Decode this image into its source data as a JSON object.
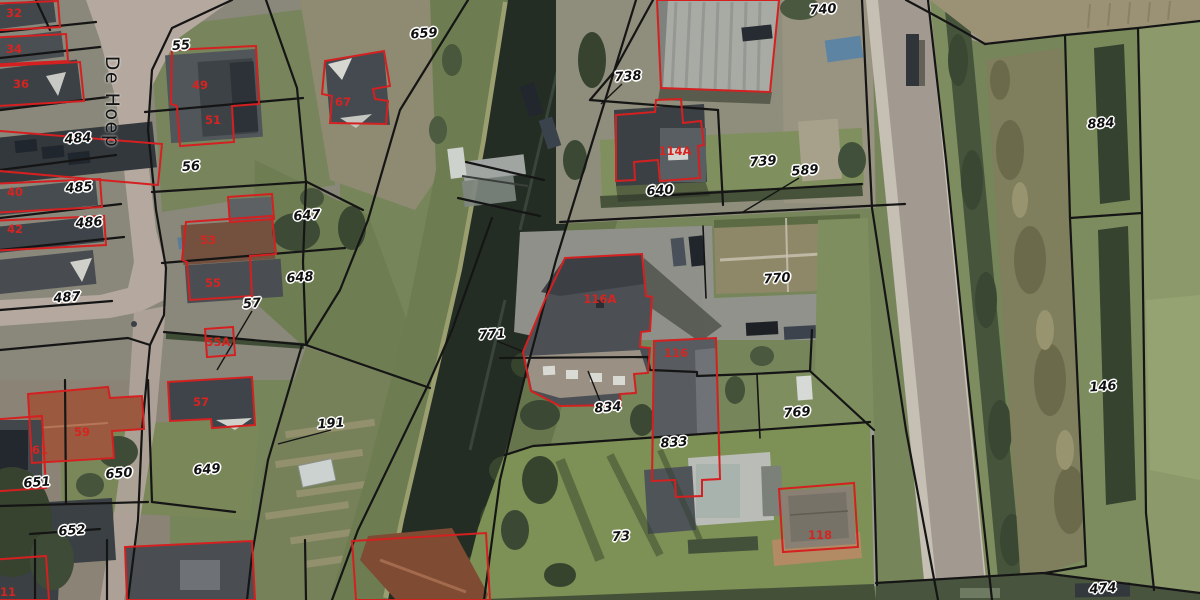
{
  "map": {
    "street_name": "De Hoep",
    "parcel_numbers": [
      "55",
      "659",
      "484",
      "56",
      "485",
      "486",
      "647",
      "648",
      "487",
      "57",
      "771",
      "191",
      "651",
      "650",
      "649",
      "652",
      "738",
      "740",
      "739",
      "589",
      "640",
      "770",
      "834",
      "833",
      "769",
      "73",
      "884",
      "146",
      "474"
    ],
    "address_numbers": [
      "32",
      "34",
      "36",
      "40",
      "42",
      "49",
      "51",
      "53",
      "55",
      "55A",
      "57",
      "59",
      "61",
      "67",
      "114A",
      "116A",
      "116",
      "118",
      "11"
    ],
    "colors": {
      "parcel_line": "#151515",
      "building_outline": "#d42020",
      "parcel_label_text": "#101010",
      "address_label_text": "#d62421",
      "label_halo": "#ffffff",
      "water": "#242d24"
    }
  }
}
